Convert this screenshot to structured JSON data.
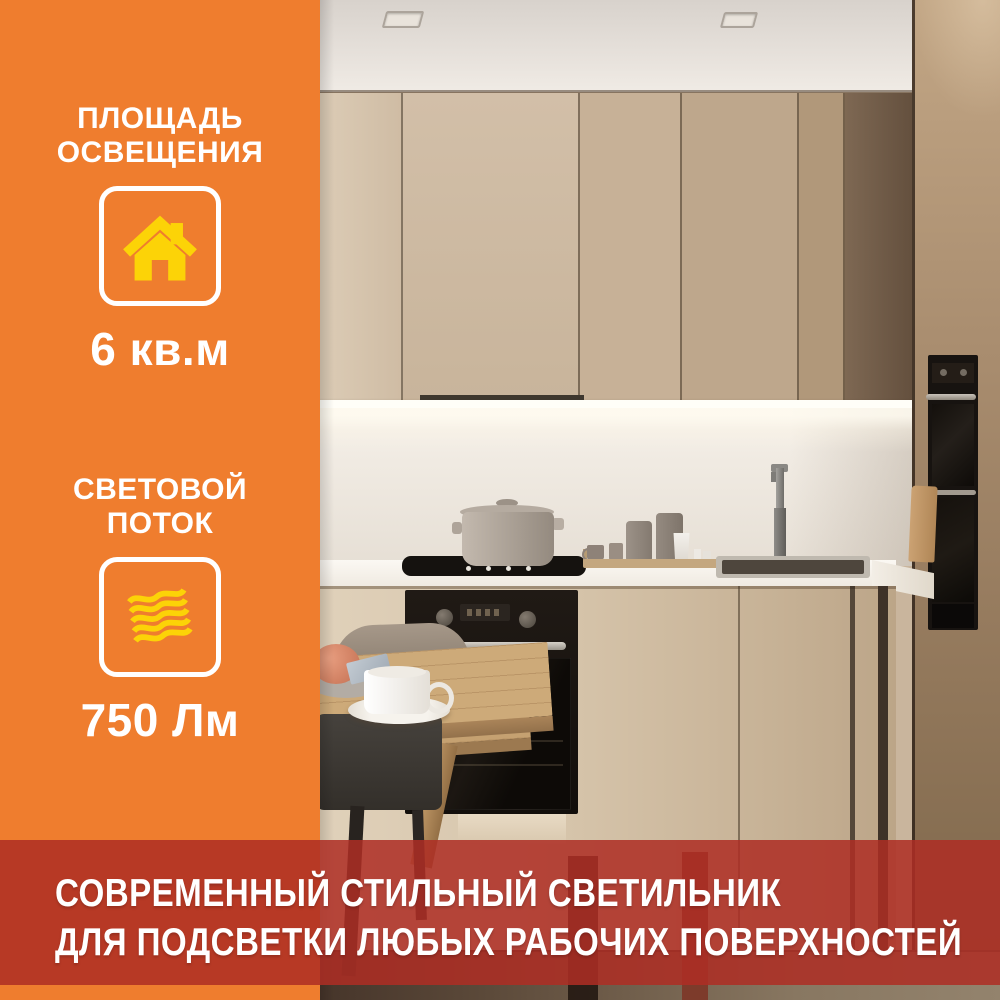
{
  "sidebar": {
    "stats": [
      {
        "label_line1": "ПЛОЩАДЬ",
        "label_line2": "ОСВЕЩЕНИЯ",
        "value": "6 кв.м",
        "icon": "house-icon"
      },
      {
        "label_line1": "СВЕТОВОЙ",
        "label_line2": "ПОТОК",
        "value": "750 Лм",
        "icon": "light-flow-icon"
      }
    ],
    "colors": {
      "bg": "#EF7D2E",
      "icon_yellow": "#FCD307",
      "text": "#FFFFFF"
    }
  },
  "banner": {
    "line1": "СОВРЕМЕННЫЙ СТИЛЬНЫЙ СВЕТИЛЬНИК",
    "line2": "ДЛЯ ПОДСВЕТКИ ЛЮБЫХ РАБОЧИХ ПОВЕРХНОСТЕЙ",
    "colors": {
      "bg": "rgba(174,45,36,0.86)",
      "text": "#FFFFFF"
    }
  }
}
